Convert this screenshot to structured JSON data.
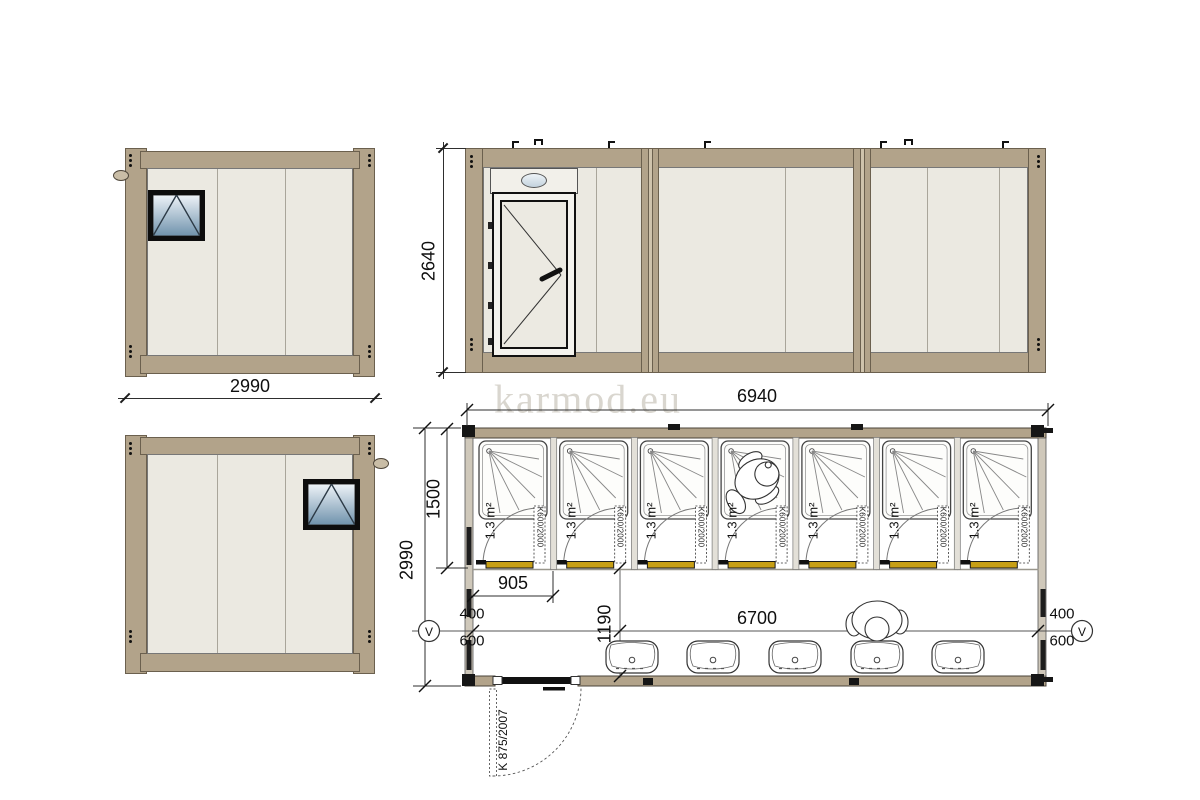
{
  "watermark": "karmod.eu",
  "colors": {
    "frame_tan": "#b2a38a",
    "wall_cream": "#ebe9e1",
    "threshold_gold": "#c79f15",
    "watermark_gray": "#d9d6cf",
    "window_glass_top": "#eef3f8",
    "window_glass_bottom": "#6f92ac"
  },
  "side_view_top": {
    "width_label": "2990"
  },
  "front_elevation": {
    "height_label": "2640"
  },
  "floor_plan": {
    "total_width_label": "6940",
    "total_depth_label": "2990",
    "shower_depth_label": "1500",
    "stall_width_label": "905",
    "interior_length_label": "6700",
    "corridor_width_label": "1190",
    "stall_area_label": "1.3 m²",
    "stall_door_label": "K600/2000",
    "entry_door_label": "K 875/2007",
    "vent_size_top": "400",
    "vent_size_bottom": "600",
    "vent_symbol": "V"
  }
}
